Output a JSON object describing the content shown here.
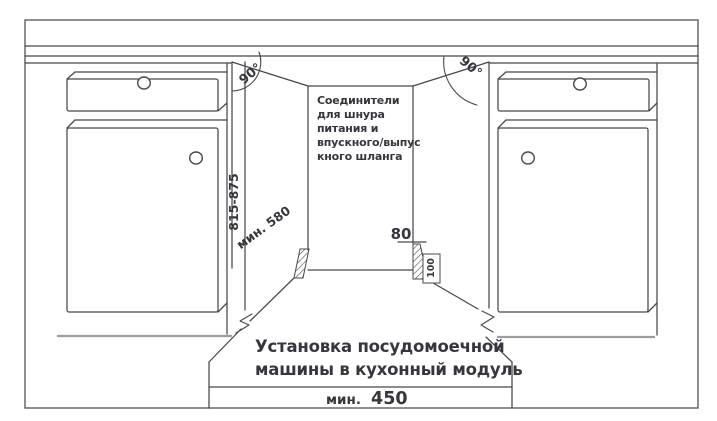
{
  "diagram": {
    "kind": "dishwasher-installation-drawing",
    "caption": {
      "line1": "Установка посудомоечной",
      "line2": "машины в кухонный модуль"
    },
    "note": {
      "line1": "Соединители",
      "line2": "для шнура",
      "line3": "питания и",
      "line4": "впускного/выпус",
      "line5": "кного шланга"
    },
    "dims": {
      "niche_height": "815-875",
      "niche_depth": "мин. 580",
      "angle_left": "90°",
      "angle_right": "90°",
      "step_height": "80",
      "step_depth": "100",
      "min_width_prefix": "мин.",
      "min_width_value": "450"
    },
    "colors": {
      "line": "#484848",
      "muted_line": "#9d9d9d",
      "text": "#36363e",
      "border": "#5f5f5f",
      "background": "#ffffff"
    }
  }
}
